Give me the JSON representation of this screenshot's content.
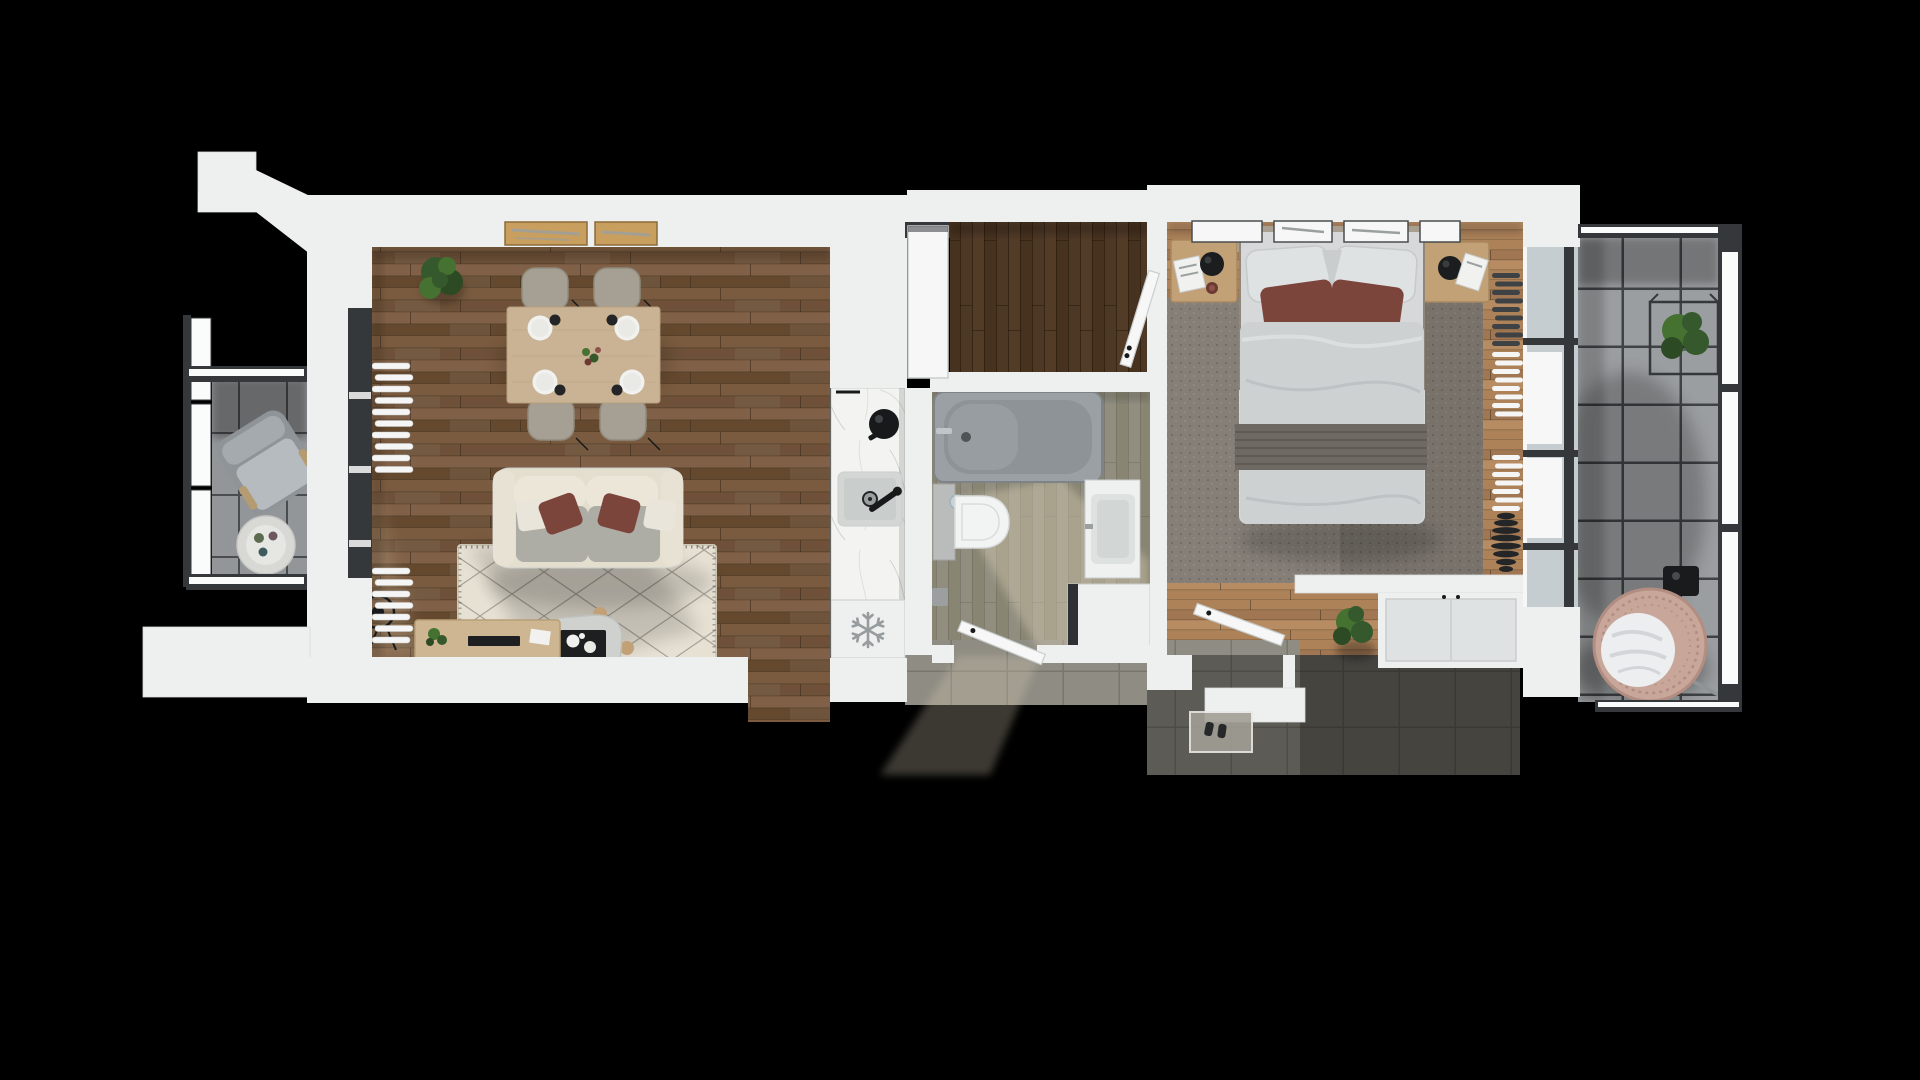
{
  "meta": {
    "description": "Photorealistic top-down 3D rendered floor plan of a one-bedroom apartment on a black background",
    "canvas": {
      "width": 1920,
      "height": 1080
    }
  },
  "icons": {
    "snowflake": "❄"
  },
  "scene": {
    "rooms": [
      {
        "id": "balcony-left",
        "floor": "grey ceramic tiles",
        "furniture": [
          "lounge-armchair",
          "round-side-table"
        ]
      },
      {
        "id": "living-room",
        "floor": "dark walnut plank wood",
        "furniture": [
          "dining-table",
          "dining-chairs-x4",
          "table-settings-x4",
          "potted-plant",
          "sofa",
          "berber-rug",
          "coffee-table",
          "wire-stool",
          "sideboard",
          "radiators-x2"
        ]
      },
      {
        "id": "kitchen",
        "floor": "open to living room",
        "furniture": [
          "marble-counter",
          "sink",
          "black-pot",
          "freezer-cabinet"
        ]
      },
      {
        "id": "entry-hall",
        "floor": "dark wood planks",
        "furniture": [
          "open-door"
        ]
      },
      {
        "id": "bathroom",
        "floor": "grey-green wood-look tiles",
        "furniture": [
          "bathtub",
          "wall-hung-toilet",
          "vanity-sink",
          "washing-machine"
        ]
      },
      {
        "id": "bedroom",
        "floor": "light oak planks",
        "furniture": [
          "double-bed",
          "nightstand-left",
          "nightstand-right",
          "bedside-lamps-x2",
          "area-carpet",
          "wall-frames-x4",
          "wardrobe",
          "potted-plant",
          "radiator-stack",
          "dark-vase"
        ]
      },
      {
        "id": "corridor",
        "floor": "grey stone tiles",
        "furniture": [
          "doormat",
          "shoes"
        ]
      },
      {
        "id": "balcony-right",
        "floor": "large grey concrete tiles",
        "furniture": [
          "hanging-egg-chair",
          "plant-in-wire-cube",
          "floor-lantern"
        ]
      }
    ]
  },
  "colors": {
    "bg": "#000000",
    "wall": "#eef0ef",
    "wallEdge": "#d9dddd",
    "wallShadow": "#c7cdcd",
    "woodLiv1": "#6e5138",
    "woodLiv2": "#7a5b3f",
    "woodLiv3": "#65492f",
    "woodLiv4": "#806046",
    "woodSeam": "#3c2d1e",
    "woodBed1": "#ad8259",
    "woodBed2": "#a17753",
    "woodBed3": "#b78c63",
    "woodHall1": "#523b27",
    "woodHall2": "#47321f",
    "woodHall3": "#4d3725",
    "bathFloor1": "#918e80",
    "bathFloor2": "#888573",
    "bathSeam": "#6f6c5c",
    "corridorTile": "#8f8c83",
    "corridorGrout": "#79766c",
    "balcTile": "#9b9ea0",
    "balcGrout": "#404346",
    "balcLTile": "#939699",
    "balcLGrout": "#4a4d50",
    "marbleBase": "#f3f4f2",
    "marbleVein": "#c9cbc9",
    "glass": "#c6cdd0",
    "frameDark": "#35383b",
    "railWhite": "#fafbfb",
    "doorWhite": "#f6f7f6",
    "doorEdge": "#c9cdcd",
    "rugCream": "#e7e1d4",
    "rugLine": "#413d36",
    "rugEdge": "#cfc8b6",
    "carpetTaupe": "#867f78",
    "sofaCream": "#e4decf",
    "sofaArm": "#e8e2d4",
    "sofaBack": "#ece6d8",
    "sofaSeat": "#adaca5",
    "pillowWhite": "#eae5da",
    "pillowMaroon": "#7c453c",
    "diningWood": "#cab394",
    "diningGrain": "#b79f7e",
    "chairBeige": "#a5a093",
    "chairEdge": "#8f8a7c",
    "plateWhite": "#f1f1ef",
    "plateInner": "#e9e9e6",
    "cupDark": "#232527",
    "green1": "#35582c",
    "green2": "#457231",
    "green3": "#2c4a24",
    "tableGray": "#cfd1ce",
    "tableEdge": "#bfc1be",
    "trayBlack": "#1d1f20",
    "sideboardWood": "#cdb691",
    "sideboardEdge": "#b89f78",
    "black": "#17191a",
    "counterSink": "#d3d6d5",
    "sinkInner": "#c9cdcc",
    "drainGray": "#9aa0a0",
    "tubOuter": "#9aa0a3",
    "tubInner": "#8d9397",
    "tubRim": "#7d8386",
    "chrome": "#c0c5c7",
    "toiletWhite": "#f2f4f4",
    "toiletEdge": "#d9dcdc",
    "cistern": "#b9bcbb",
    "flushBlue": "#c3d4d8",
    "vanityWhite": "#eff1f0",
    "vanitySink": "#dde1e0",
    "washerWhite": "#eef0ef",
    "washerDark": "#2e3133",
    "duvet": "#ced1d2",
    "duvetFold": "#b4b8ba",
    "duvetLight": "#dde0e1",
    "runner": "#6e6962",
    "runnerStripe": "#5f5a54",
    "bedPillow": "#dfe2e3",
    "bedPillowEdge": "#c6cacb",
    "headboard": "#a89f90",
    "nightstand": "#c2a176",
    "nightstandEdge": "#a8885e",
    "lampBlack": "#1b1d1e",
    "maroonDeep": "#6d3a33",
    "maroonLight": "#8d5248",
    "radWhite": "#f4f5f4",
    "radDark": "#3f4244",
    "vaseBlack": "#232527",
    "wardrobePanel": "#dfe2e2",
    "wardrobeLine": "#c8cccc",
    "matLight": "#a19e95",
    "eggRing": "#c9a69a",
    "eggRingDark": "#b28d82",
    "eggCushion": "#eceef0",
    "cushionFold": "#d3d6d9",
    "lanternBlack": "#191b1c",
    "lightBeige": "#d8cdb4",
    "tanFrame": "#c99f5f",
    "tanFrameEdge": "#8a6a3a",
    "artGray": "#9aa0a0",
    "snowflake": "#979c9e",
    "shadow": "#000000"
  }
}
